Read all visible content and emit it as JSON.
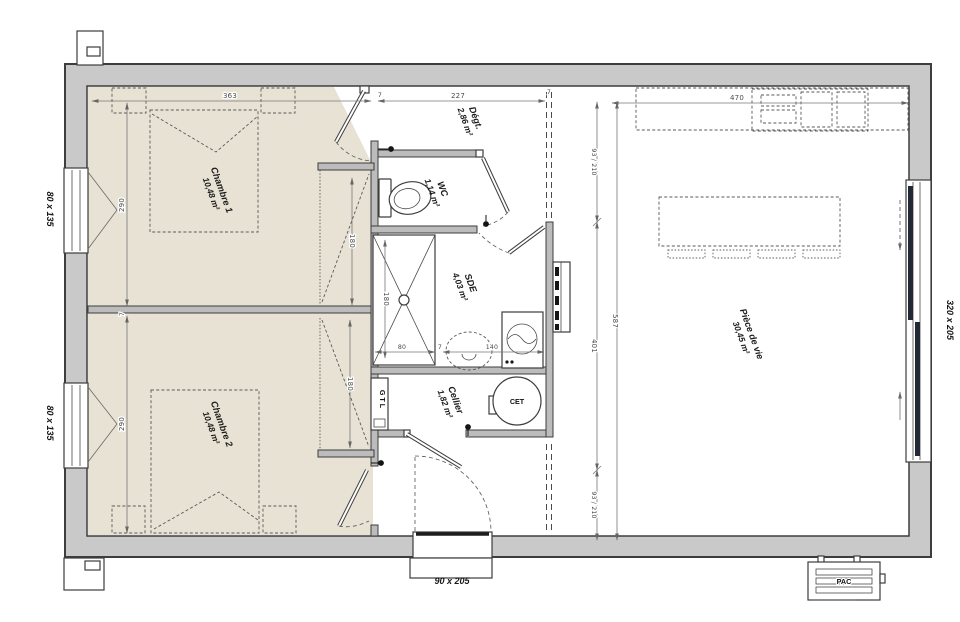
{
  "plan": {
    "rooms": {
      "chambre1": {
        "name": "Chambre 1",
        "area": "10,48 m²"
      },
      "chambre2": {
        "name": "Chambre 2",
        "area": "10,48 m²"
      },
      "wc": {
        "name": "WC",
        "area": "1,14 m²"
      },
      "sde": {
        "name": "SDE",
        "area": "4,03 m²"
      },
      "cellier": {
        "name": "Cellier",
        "area": "1,82 m²"
      },
      "degagement": {
        "name": "Dégt.",
        "area": "2,86 m²"
      },
      "piece_de_vie": {
        "name": "Pièce de vie",
        "area": "30,45 m²"
      }
    },
    "equipment": {
      "water_heater": "CET",
      "electrical_box": "GTL",
      "heat_pump": "PAC"
    },
    "openings": {
      "window_left_top": "80 x 135",
      "window_left_bottom": "80 x 135",
      "bay_window_right": "320 x 205",
      "entry_door": "90 x 205"
    },
    "dimensions": {
      "chambre_width": "363",
      "degagement_width": "227",
      "kitchen_width": "470",
      "wall_thickness": "7",
      "chambre1_height": "290",
      "chambre2_height": "290",
      "wardrobe1": "180",
      "wardrobe2": "180",
      "shower_length": "180",
      "shower_width": "80",
      "vanity_width": "140",
      "opening_top": "93 / 210",
      "living_mid": "401",
      "opening_bottom": "93 / 210",
      "living_total": "587"
    }
  }
}
